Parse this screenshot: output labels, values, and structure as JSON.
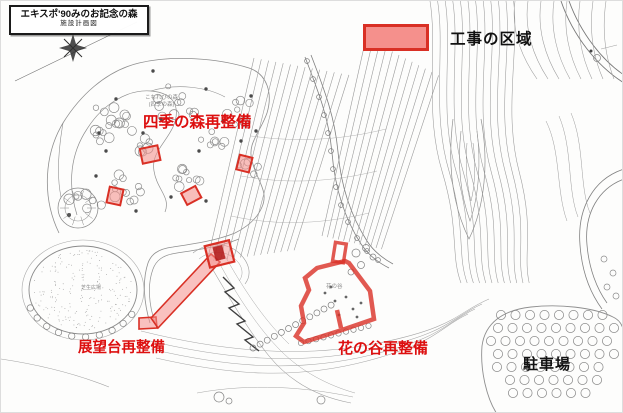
{
  "title_block": {
    "title": "エキスポ'90みのお記念の森",
    "subtitle": "施設計画図"
  },
  "legend": {
    "label": "工事の区域"
  },
  "labels": {
    "shiki_no_mori": "四季の森再整備",
    "tenbodai": "展望台再整備",
    "hana_no_tani": "花の谷再整備",
    "parking": "駐車場"
  },
  "map_small_labels": {
    "forest_line1": "こもれびの森",
    "forest_line2": "(四季の森)",
    "lawn": "芝生広場",
    "valley": "花の谷"
  },
  "colors": {
    "annotation_red": "#dd0f0f",
    "zone_fill": "#f5908c",
    "zone_border": "#d93025",
    "label_black": "#111111"
  }
}
